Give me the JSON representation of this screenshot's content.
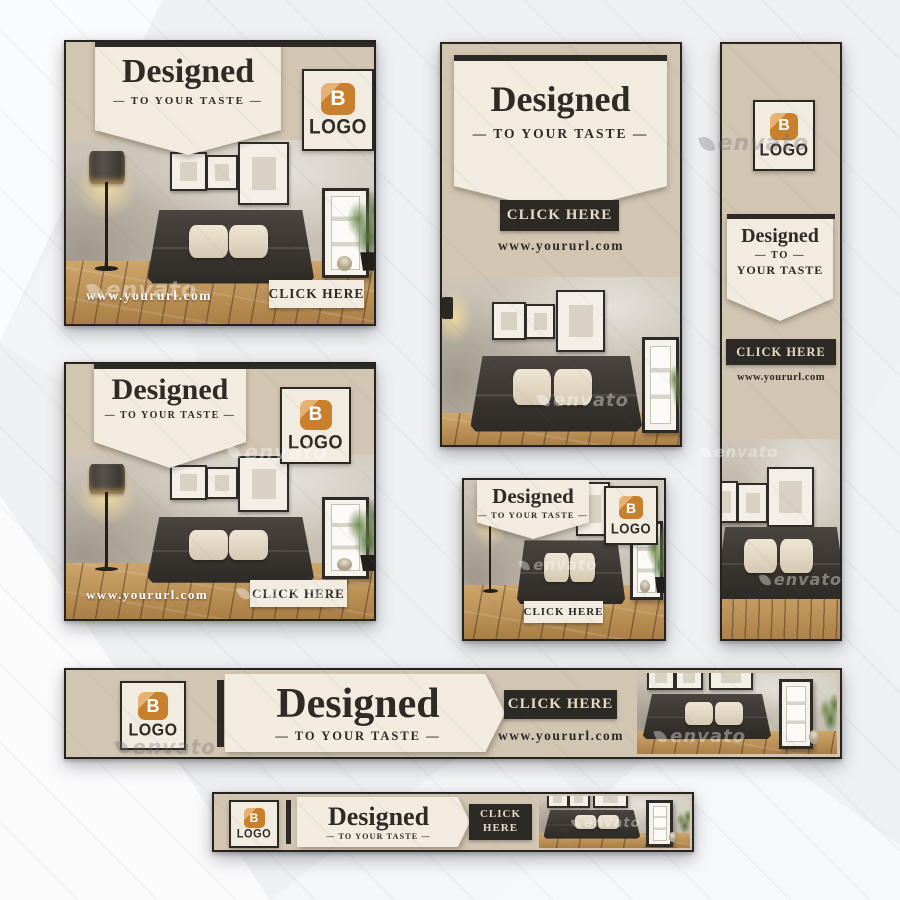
{
  "brand": {
    "title": "Designed",
    "tagline": "— TO YOUR TASTE —",
    "tagline_to": "— TO —",
    "tagline_taste": "YOUR TASTE",
    "cta": "CLICK HERE",
    "cta_line1": "CLICK",
    "cta_line2": "HERE",
    "url": "www.yoururl.com",
    "logo_letter": "B",
    "logo_text": "LOGO"
  },
  "watermark": {
    "text": "envato"
  },
  "colors": {
    "tan": "#d2c5b2",
    "cream": "#f1ebe0",
    "dark": "#2d2a25",
    "orange": "#c8802d",
    "orange_light": "#e6b273",
    "cta_text": "#e5dbc7",
    "url_light": "#ffffff"
  }
}
